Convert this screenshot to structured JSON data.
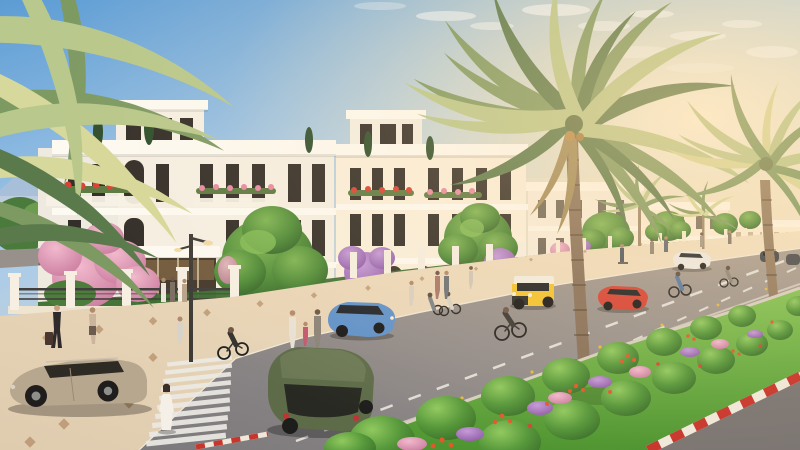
{
  "scene": {
    "kind": "architectural-render",
    "elements": {
      "sky": "clear sky with wispy clouds and warm sun glow at upper right",
      "villas": "row of white neoclassical villas with balconies and flower boxes",
      "palm": "large date palms along street",
      "median": "landscaped median with round bushes and flowers",
      "road": "asphalt road with zebra crossing and dashed lane lines"
    }
  },
  "palette": {
    "sky_top": "#5c9cd4",
    "sky_mid": "#a9cbe9",
    "sky_horizon": "#f6e2c4",
    "sun_glow": "#fff6df",
    "cloud_white": "#ffffff",
    "mountain_haze": "#b5bfd2",
    "building_face": "#f5efe3",
    "building_warm": "#faf0dd",
    "building_trim": "#fdfaf2",
    "window_dark": "#332e29",
    "glass_warm": "#c89b62",
    "storefront_glass": "#46392c",
    "roof_tree": "#2f4f2d",
    "hedge_green": "#3f6f33",
    "tree_light": "#7fb554",
    "tree_dark": "#35632a",
    "bush_light": "#90c95e",
    "bush_dark": "#3a702a",
    "grass_light": "#83c252",
    "grass_dark": "#4d9430",
    "pink_light": "#f2b9cd",
    "pink_dark": "#c97b9d",
    "purple_light": "#c59ad8",
    "purple_dark": "#8e5aa8",
    "flower_orange": "#e2582b",
    "flower_red": "#d84234",
    "palm_light": "#b9c88c",
    "palm_mid": "#7e9a63",
    "palm_dark": "#5a7a4c",
    "palm_sun": "#d7d89b",
    "trunk_brown": "#87705a",
    "dead_frond": "#a08b5a",
    "pave_left": "#dfcbae",
    "pave_right": "#f2e0c2",
    "paver_accent": "#aa7f58",
    "road_left": "#7c797c",
    "road_mid": "#948e8c",
    "road_right": "#a89c90",
    "marking_white": "#eceae4",
    "stud_yellow": "#e6b93e",
    "curb_red": "#c8352c",
    "curb_stone": "#f0e8db",
    "fence_white": "#f6efe2",
    "railing_dark": "#413f3c",
    "pole_gray": "#3e3b37",
    "corner_road": "#7b7572"
  },
  "vehicles": {
    "beige_suv": {
      "label": "beige SUV near crosswalk",
      "color": "#b7a78f"
    },
    "green_suv": {
      "label": "olive green SUV",
      "color": "#5d6b49"
    },
    "blue_crossover": {
      "label": "blue crossover at curb",
      "color": "#5f92cb"
    },
    "yellow_jeep": {
      "label": "yellow compact 4x4 with white roof",
      "color": "#f1c32e"
    },
    "red_suv": {
      "label": "red SUV",
      "color": "#d64234"
    },
    "white_sedan": {
      "label": "white crossover",
      "color": "#eceae6"
    },
    "dark_car_a": {
      "label": "dark car",
      "color": "#3c4148"
    },
    "dark_car_b": {
      "label": "dark car far right",
      "color": "#45484d"
    },
    "yellow_sports": {
      "label": "yellow sports car on side street",
      "color": "#e9c63d"
    }
  }
}
